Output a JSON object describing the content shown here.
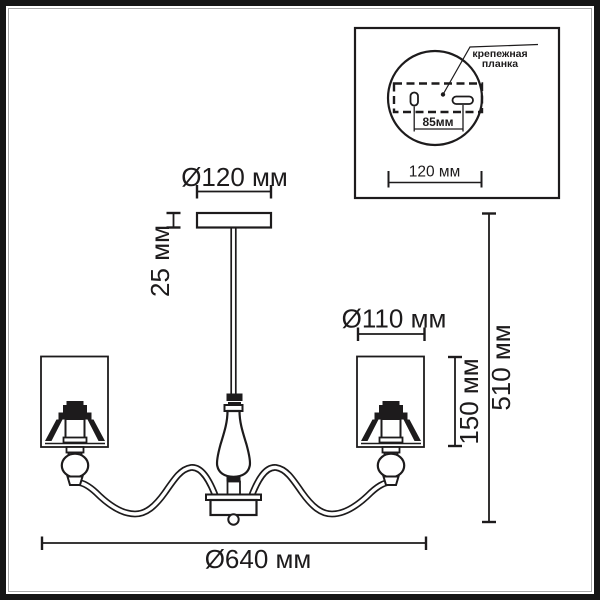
{
  "colors": {
    "line": "#1d1b1c",
    "background": "#ffffff"
  },
  "dimensions": {
    "canopy_diameter": "Ø120 мм",
    "canopy_height": "25 мм",
    "shade_diameter": "Ø110 мм",
    "shade_height": "150 мм",
    "total_height": "510 мм",
    "total_diameter": "Ø640 мм"
  },
  "inset": {
    "label_line1": "крепежная",
    "label_line2": "планка",
    "slot_spacing": "85мм",
    "plate_diameter": "120 мм"
  }
}
